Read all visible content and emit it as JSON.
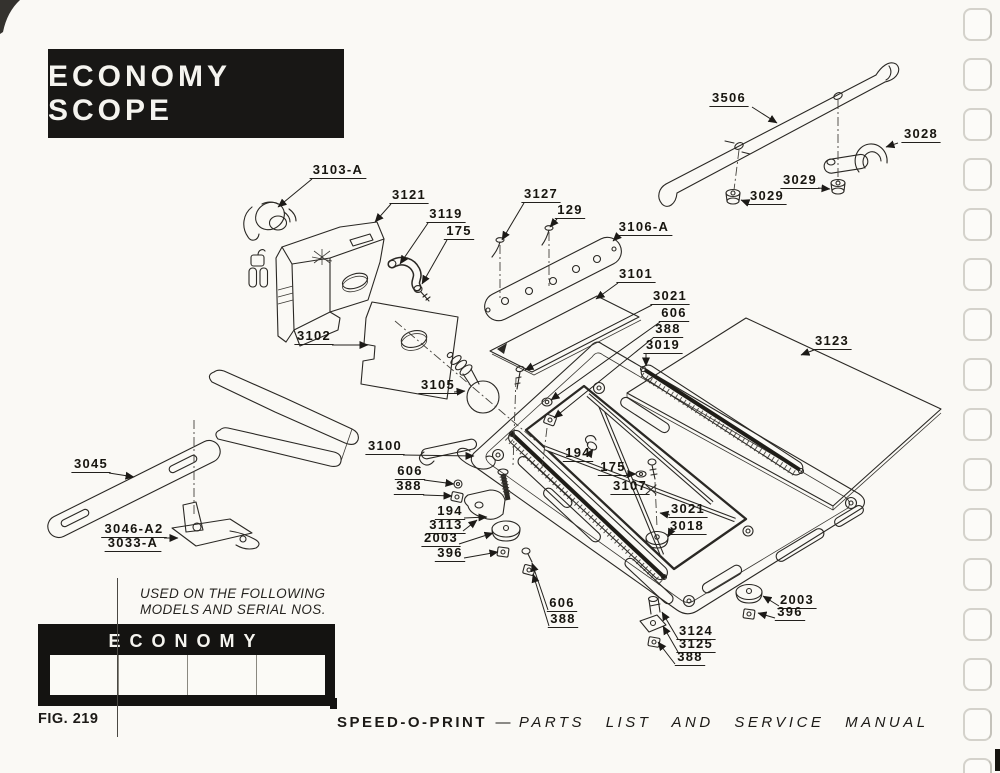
{
  "page": {
    "title_block": "ECONOMY SCOPE",
    "used_on_line1": "USED ON THE FOLLOWING",
    "used_on_line2": "MODELS AND SERIAL NOS.",
    "models_table": {
      "header": "ECONOMY",
      "cells": [
        "",
        "",
        "",
        ""
      ]
    },
    "fig_caption": "FIG. 219",
    "footer": {
      "brand": "SPEED-O-PRINT",
      "separator": "—",
      "title": "PARTS  LIST  AND  SERVICE  MANUAL"
    }
  },
  "diagram": {
    "figure_number": "219",
    "ink_color": "#2a2824",
    "paper_color": "#faf9f5",
    "parts": [
      {
        "t": "3506",
        "x": 729,
        "y": 102,
        "ax": 752,
        "ay": 107,
        "tx": 777,
        "ty": 123
      },
      {
        "t": "3028",
        "x": 921,
        "y": 138,
        "ax": 898,
        "ay": 143,
        "tx": 886,
        "ty": 147
      },
      {
        "t": "3029",
        "x": 800,
        "y": 184,
        "ax": 818,
        "ay": 188,
        "tx": 830,
        "ty": 189
      },
      {
        "t": "3029",
        "x": 767,
        "y": 200,
        "ax": 749,
        "ay": 203,
        "tx": 741,
        "ty": 200
      },
      {
        "t": "3103-A",
        "x": 338,
        "y": 174,
        "ax": 312,
        "ay": 179,
        "tx": 278,
        "ty": 207
      },
      {
        "t": "3121",
        "x": 409,
        "y": 199,
        "ax": 391,
        "ay": 204,
        "tx": 375,
        "ty": 222
      },
      {
        "t": "3119",
        "x": 446,
        "y": 218,
        "ax": 428,
        "ay": 223,
        "tx": 400,
        "ty": 264
      },
      {
        "t": "175",
        "x": 459,
        "y": 235,
        "ax": 447,
        "ay": 240,
        "tx": 422,
        "ty": 284
      },
      {
        "t": "3127",
        "x": 541,
        "y": 198,
        "ax": 524,
        "ay": 203,
        "tx": 502,
        "ty": 240
      },
      {
        "t": "129",
        "x": 570,
        "y": 214,
        "ax": 557,
        "ay": 219,
        "tx": 550,
        "ty": 227
      },
      {
        "t": "3106-A",
        "x": 644,
        "y": 231,
        "ax": 618,
        "ay": 236,
        "tx": 613,
        "ty": 241
      },
      {
        "t": "3101",
        "x": 636,
        "y": 278,
        "ax": 618,
        "ay": 283,
        "tx": 596,
        "ty": 299
      },
      {
        "t": "3021",
        "x": 670,
        "y": 300,
        "ax": 652,
        "ay": 305,
        "tx": 525,
        "ty": 370
      },
      {
        "t": "606",
        "x": 674,
        "y": 317,
        "ax": 660,
        "ay": 322,
        "tx": 551,
        "ty": 400
      },
      {
        "t": "388",
        "x": 668,
        "y": 333,
        "ax": 653,
        "ay": 338,
        "tx": 554,
        "ty": 418
      },
      {
        "t": "3019",
        "x": 663,
        "y": 349,
        "ax": 646,
        "ay": 354,
        "tx": 646,
        "ty": 366
      },
      {
        "t": "3123",
        "x": 832,
        "y": 345,
        "ax": 814,
        "ay": 350,
        "tx": 801,
        "ty": 355
      },
      {
        "t": "3102",
        "x": 314,
        "y": 340,
        "ax": 332,
        "ay": 345,
        "tx": 368,
        "ty": 345
      },
      {
        "t": "3105",
        "x": 438,
        "y": 389,
        "ax": 454,
        "ay": 392,
        "tx": 465,
        "ty": 391
      },
      {
        "t": "3100",
        "x": 385,
        "y": 450,
        "ax": 403,
        "ay": 455,
        "tx": 474,
        "ty": 456
      },
      {
        "t": "606",
        "x": 410,
        "y": 475,
        "ax": 424,
        "ay": 480,
        "tx": 454,
        "ty": 484
      },
      {
        "t": "388",
        "x": 409,
        "y": 490,
        "ax": 423,
        "ay": 495,
        "tx": 452,
        "ty": 496
      },
      {
        "t": "194",
        "x": 450,
        "y": 515,
        "ax": 464,
        "ay": 518,
        "tx": 487,
        "ty": 517
      },
      {
        "t": "3113",
        "x": 446,
        "y": 529,
        "ax": 463,
        "ay": 531,
        "tx": 477,
        "ty": 520
      },
      {
        "t": "2003",
        "x": 441,
        "y": 542,
        "ax": 459,
        "ay": 544,
        "tx": 493,
        "ty": 533
      },
      {
        "t": "396",
        "x": 450,
        "y": 557,
        "ax": 464,
        "ay": 558,
        "tx": 498,
        "ty": 552
      },
      {
        "t": "194",
        "x": 578,
        "y": 457,
        "ax": 589,
        "ay": 455,
        "tx": 593,
        "ty": 449
      },
      {
        "t": "175",
        "x": 613,
        "y": 471,
        "ax": 626,
        "ay": 474,
        "tx": 636,
        "ty": 474
      },
      {
        "t": "3107",
        "x": 630,
        "y": 490,
        "ax": 644,
        "ay": 490,
        "tx": 644,
        "ty": 490,
        "arr": false
      },
      {
        "t": "3021",
        "x": 688,
        "y": 513,
        "ax": 670,
        "ay": 515,
        "tx": 660,
        "ty": 513
      },
      {
        "t": "3018",
        "x": 687,
        "y": 530,
        "ax": 670,
        "ay": 533,
        "tx": 668,
        "ty": 537
      },
      {
        "t": "606",
        "x": 562,
        "y": 607,
        "ax": 548,
        "ay": 610,
        "tx": 532,
        "ty": 563
      },
      {
        "t": "388",
        "x": 563,
        "y": 623,
        "ax": 549,
        "ay": 626,
        "tx": 533,
        "ty": 574
      },
      {
        "t": "3124",
        "x": 696,
        "y": 635,
        "ax": 678,
        "ay": 639,
        "tx": 662,
        "ty": 612
      },
      {
        "t": "3125",
        "x": 696,
        "y": 648,
        "ax": 678,
        "ay": 652,
        "tx": 663,
        "ty": 626
      },
      {
        "t": "388",
        "x": 690,
        "y": 661,
        "ax": 675,
        "ay": 664,
        "tx": 658,
        "ty": 642
      },
      {
        "t": "2003",
        "x": 797,
        "y": 604,
        "ax": 779,
        "ay": 606,
        "tx": 763,
        "ty": 596
      },
      {
        "t": "396",
        "x": 790,
        "y": 616,
        "ax": 775,
        "ay": 618,
        "tx": 758,
        "ty": 613
      },
      {
        "t": "3045",
        "x": 91,
        "y": 468,
        "ax": 109,
        "ay": 473,
        "tx": 134,
        "ty": 477
      },
      {
        "t": "3046-A2",
        "x": 134,
        "y": 533,
        "ax": 164,
        "ay": 538,
        "tx": 178,
        "ty": 538
      },
      {
        "t": "3033-A",
        "x": 133,
        "y": 547,
        "ax": 0,
        "ay": 0,
        "tx": 0,
        "ty": 0,
        "arr": false
      }
    ]
  }
}
